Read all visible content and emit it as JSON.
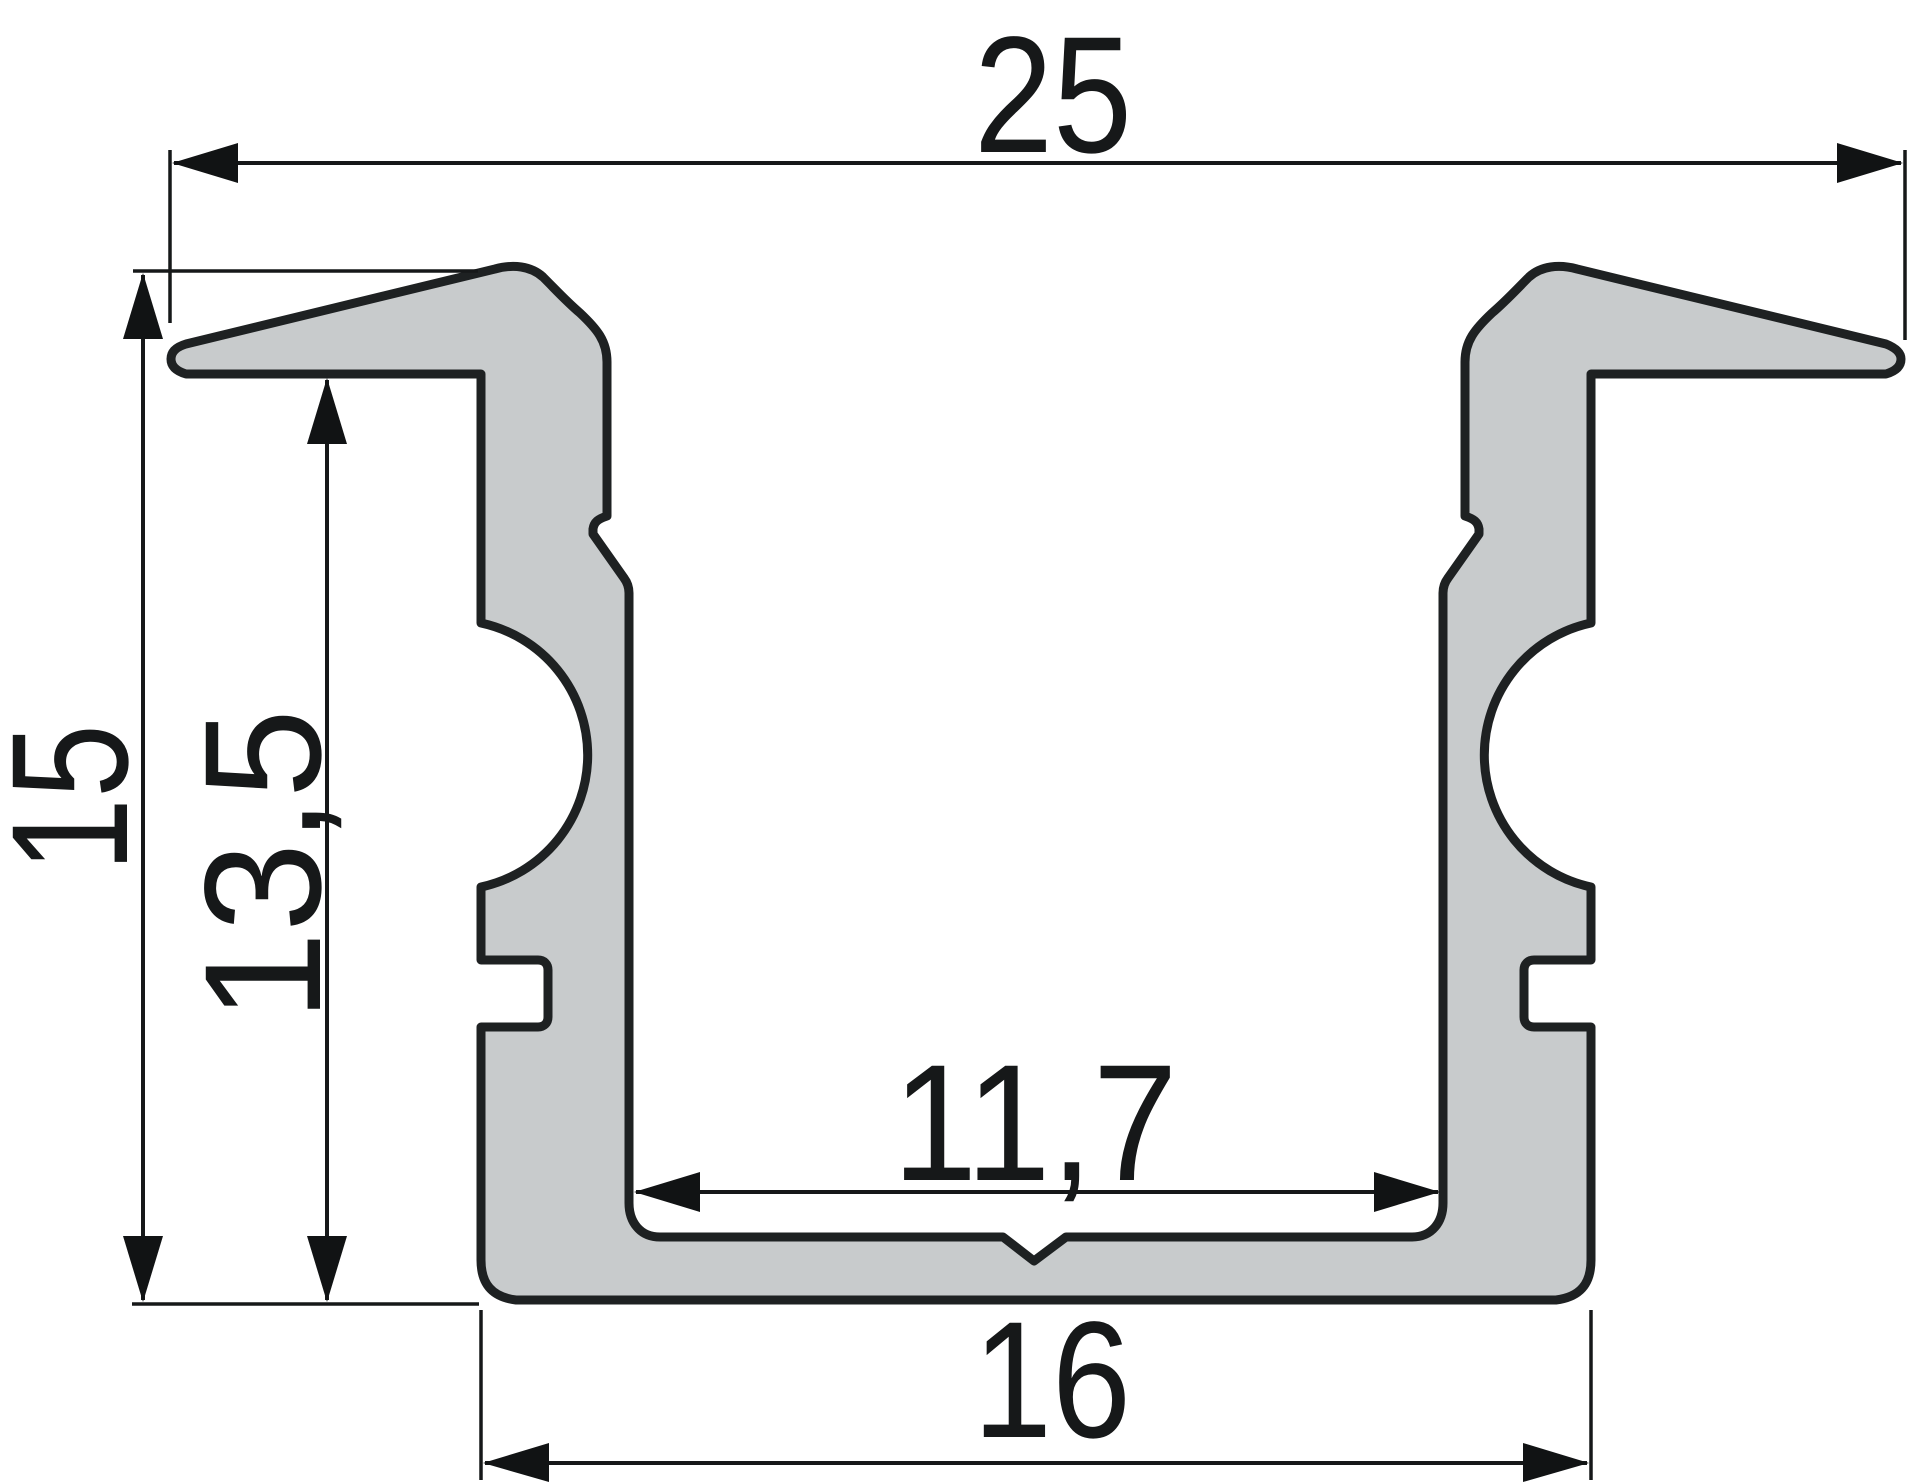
{
  "drawing": {
    "kind": "profile-cross-section-technical-drawing",
    "dimensions": {
      "overall_width": "25",
      "overall_height": "15",
      "inner_height": "13,5",
      "inner_width": "11,7",
      "base_width": "16"
    },
    "colors": {
      "background": "#ffffff",
      "profile_fill": "#c8cbcc",
      "profile_outline": "#1e2122",
      "dimension_ink": "#161819"
    }
  }
}
